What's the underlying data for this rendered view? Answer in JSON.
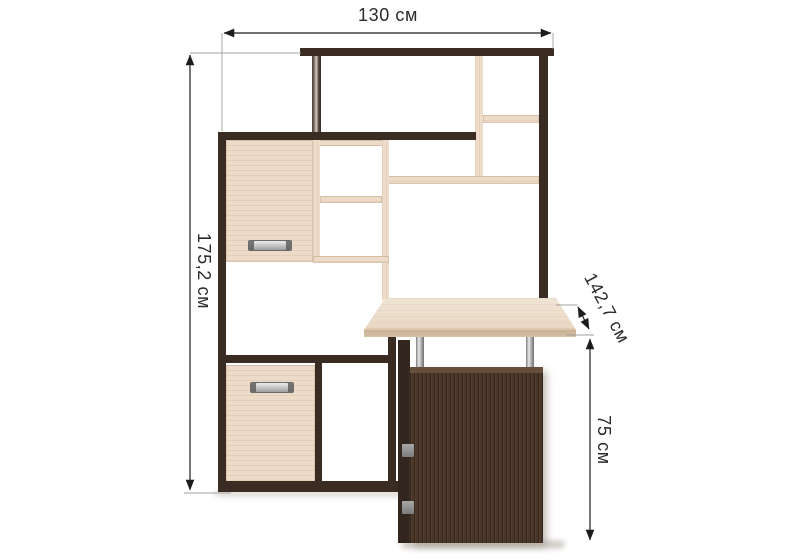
{
  "dimension_labels": {
    "width": "130 см",
    "height": "175,2 см",
    "depth": "142,7 см",
    "desk_height": "75 см"
  },
  "colors": {
    "frame_dark_wood": "#3a2c23",
    "pedestal_wood": "#49362a",
    "panel_light_wood": "#ecdbc8",
    "desk_top_wood": "#ecddca",
    "chrome": "#c8c8c8",
    "dimension_line": "#1c1c1c",
    "guide_line": "#a0a0a0",
    "label_text": "#2b2b2b",
    "background": "#ffffff"
  }
}
